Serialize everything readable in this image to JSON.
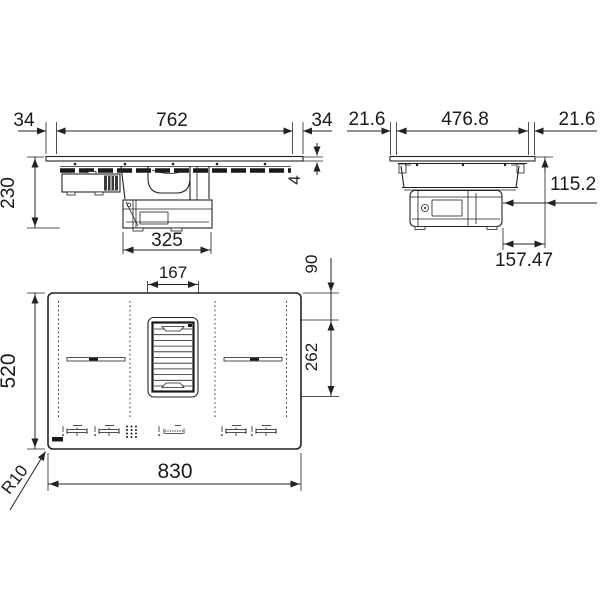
{
  "drawing": {
    "title": "hob-installation-dimension-drawing",
    "side_view": {
      "dim_left_overhang": "34",
      "dim_body_width": "762",
      "dim_right_overhang": "34",
      "dim_total_height": "230",
      "dim_glass_thickness": "4",
      "dim_blower_width": "325"
    },
    "front_view": {
      "dim_left_overhang": "21.6",
      "dim_body_depth": "476.8",
      "dim_right_overhang": "21.6",
      "dim_under_glass_height": "115.2",
      "dim_blower_offset": "157.47"
    },
    "top_view": {
      "dim_grille_width": "167",
      "dim_grille_top_offset": "90",
      "dim_grille_length": "262",
      "dim_hob_depth": "520",
      "dim_hob_width": "830",
      "dim_corner_radius": "R10"
    },
    "colors": {
      "line": "#222222",
      "background": "#ffffff"
    }
  }
}
